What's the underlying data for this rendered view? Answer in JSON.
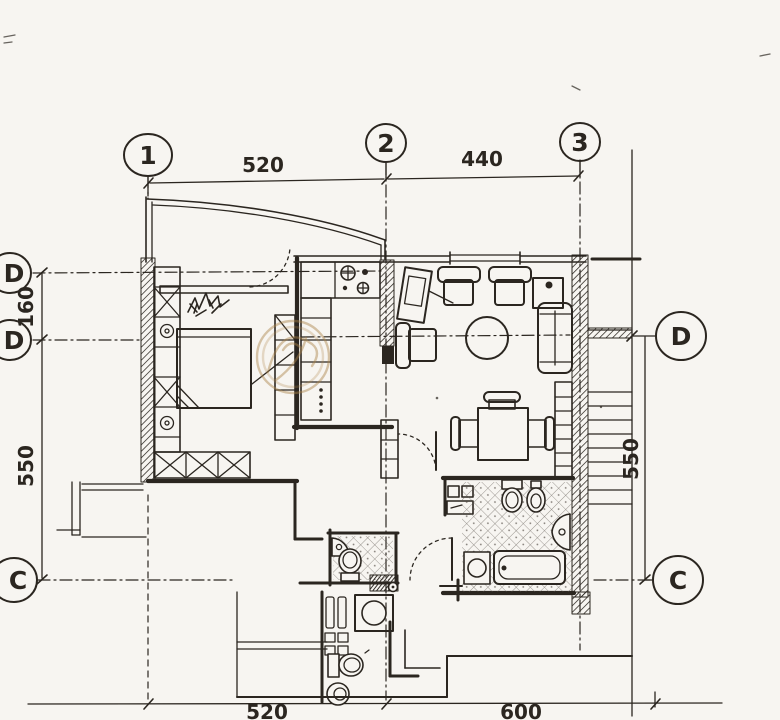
{
  "document": {
    "kind": "scanned floor plan drawing",
    "colors": {
      "ink": "#2b2620",
      "paper": "#f7f5f1",
      "watermark": "#ab8348"
    }
  },
  "grid": {
    "columns": [
      {
        "label": "1"
      },
      {
        "label": "2"
      },
      {
        "label": "3"
      }
    ],
    "rows_left": [
      {
        "label": "D"
      },
      {
        "label": "D"
      },
      {
        "label": "C"
      }
    ],
    "rows_right": [
      {
        "label": "D"
      },
      {
        "label": "C"
      }
    ]
  },
  "dimensions": {
    "top": [
      {
        "value": "520"
      },
      {
        "value": "440"
      }
    ],
    "left": [
      {
        "value": "160"
      },
      {
        "value": "550"
      }
    ],
    "right": [
      {
        "value": "550"
      }
    ],
    "bottom": [
      {
        "value": "520"
      },
      {
        "value": "600"
      }
    ]
  }
}
